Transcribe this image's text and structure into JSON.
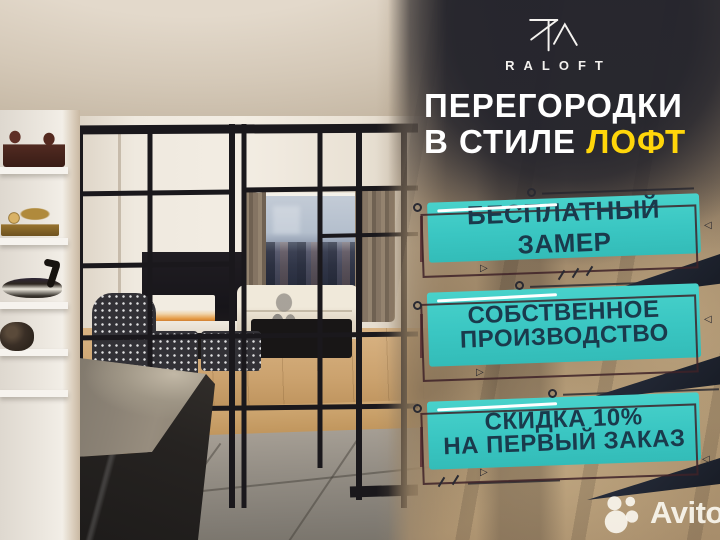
{
  "brand": {
    "name": "RALOFT",
    "monogram": "RA"
  },
  "headline": {
    "line1": "ПЕРЕГОРОДКИ",
    "line2": "В СТИЛЕ",
    "highlight": "ЛОФТ"
  },
  "badges": [
    {
      "lines": [
        "БЕСПЛАТНЫЙ ЗАМЕР"
      ]
    },
    {
      "lines": [
        "СОБСТВЕННОЕ",
        "ПРОИЗВОДСТВО"
      ]
    },
    {
      "lines": [
        "СКИДКА 10%",
        "НА ПЕРВЫЙ ЗАКАЗ"
      ]
    }
  ],
  "watermark": {
    "label": "Avito"
  },
  "photo": {
    "alt": "Интерьер квартиры с чёрными стеклянными перегородками в стиле лофт"
  },
  "colors": {
    "accent_teal": "#3AC6C2",
    "highlight_yellow": "#FFD60A",
    "badge_text": "#1A3A4C",
    "panel_dark": "#24242C",
    "flag_navy": "#1F2430"
  }
}
